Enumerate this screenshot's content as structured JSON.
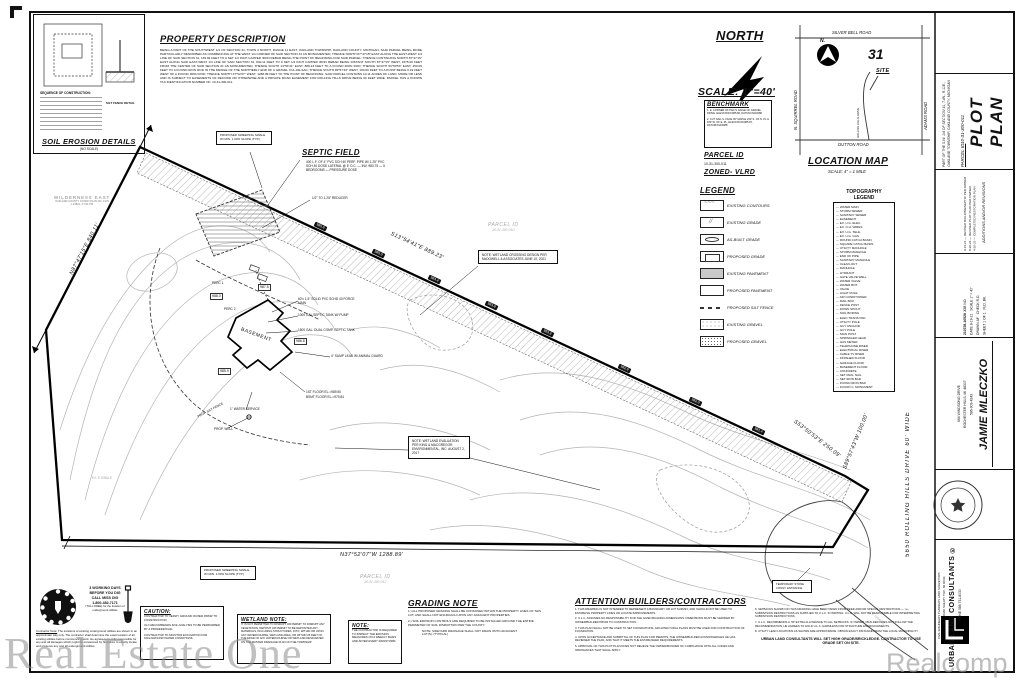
{
  "watermarks": {
    "left": "Real Estate One",
    "right": "Realcomp"
  },
  "property_description": {
    "title": "PROPERTY DESCRIPTION",
    "body": "BEING A PART OF THE SOUTHWEST 1/4 OF SECTION 31, TOWN 4 NORTH, RANGE 11 EAST, OAKLAND TOWNSHIP, OAKLAND COUNTY, MICHIGAN, SAID PARCEL BEING MORE PARTICULARLY DESCRIBED AS COMMENCING AT THE WEST 1/4 CORNER OF SAID SECTION 31 AS MONUMENTED; THENCE NORTH 87°47'15\" EAST ALONG THE EAST-WEST 1/4 LINE OF SAID SECTION 31, 139.84 FEET TO A SET 1/2 INCH CAPPED IRON REBAR BEING THE POINT OF BEGINNING FOR SAID PARCEL; THENCE CONTINUING NORTH 87°47'15\" EAST ALONG SAID EAST-WEST 1/4 LINE OF SAID SECTION 31, 840.11 FEET TO A SET 1/2 INCH CAPPED IRON REBAR BEING DISTANT SOUTH 87°47'15\" WEST, 1575.06 FEET FROM THE CENTER OF SAID SECTION 31 AS MONUMENTED; THENCE SOUTH 13°54'41\" EAST, 889.23 FEET TO A FOUND IRON ROD; THENCE SOUTH 53°50'53\" EAST, 250.09 FEET TO A FOUND IRON ROD IN THE MIDDLE OF THE NORTHERLY END OF A GRAVEL CUL-DE-SAC; THENCE SOUTH 89°57'43\" WEST, 100.00 FEET TO A POINT BEING 0.19 FEET WEST OF A FOUND IRON ROD; THENCE NORTH 37°52'07\" WEST, 1288.89 FEET TO THE POINT OF BEGINNING. SAID PARCEL CONTAINS 10.11 ACRES OF LAND, MORE OR LESS AND IS SUBJECT TO EASEMENTS OF RECORD OR OTHERWISE AND A PRIVATE ROAD EASEMENT FOR ROLLING HILLS DRIVE BEING 60 FEET WIDE. PARCEL HAS A KNOWN TAX IDENTIFICATION NUMBER OF: 10-31-300-011."
  },
  "soil_erosion": {
    "title": "SOIL EROSION DETAILS",
    "subtitle": "(NO SCALE)",
    "sequence_title": "SEQUENCE OF CONSTRUCTION:",
    "silt_detail_label": "SILT FENCE DETAIL"
  },
  "north_block": {
    "north_label": "NORTH",
    "scale_label": "SCALE:  1\"=40'"
  },
  "benchmark": {
    "title": "BENCHMARK",
    "items": [
      "1.  E. CORNER OF PAD S. EDGE OF GRAVEL DRIVE, ELEVATION=985.80, DATUM=NAVD88",
      "2.  CUT NAIL S. FACE 36\" MAPLE 230' S. OF N. PL & 180' W. OF E. PL, ELEVATION=985.87, DATUM=NAVD88"
    ]
  },
  "parcel_block": {
    "parcel_title": "PARCEL ID",
    "parcel_value": "10-31-300-011",
    "zoned": "ZONED- VLRD"
  },
  "location_map": {
    "title": "LOCATION MAP",
    "scale": "SCALE:  4\" = 1 MILE",
    "section_number": "31",
    "site_label": "SITE",
    "north_label": "N.",
    "roads": {
      "top": "SILVER BELL ROAD",
      "left": "N. SQUIRREL ROAD",
      "right": "ADAMS ROAD",
      "bottom": "DUTTON ROAD",
      "site_road": "ROLLING HILLS DRIVE"
    }
  },
  "legend": {
    "title": "LEGEND",
    "items": [
      {
        "type": "contour",
        "label": "EXISTING CONTOURS"
      },
      {
        "type": "exgrade",
        "label": "EXISTING GRADE"
      },
      {
        "type": "asbuilt",
        "label": "AS-BUILT GRADE"
      },
      {
        "type": "propgrade",
        "label": "PROPOSED GRADE"
      },
      {
        "type": "expave",
        "label": "EXISTING PAVEMENT"
      },
      {
        "type": "propave",
        "label": "PROPOSED PAVEMENT"
      },
      {
        "type": "silt",
        "label": "PROPOSED SILT FENCE"
      },
      {
        "type": "exgravel",
        "label": "EXISTING GRAVEL"
      },
      {
        "type": "propgravel",
        "label": "PROPOSED GRAVEL"
      }
    ]
  },
  "topo_legend": {
    "title_line1": "TOPOGRAPHY",
    "title_line2": "LEGEND",
    "items": [
      "WATER MAIN",
      "STORM SEWER",
      "SANITARY SEWER",
      "EASEMENT",
      "EX. U.G. ELEC.",
      "EX. O.H. WIRES",
      "EX. U.G. TELE.",
      "EX. U.G. GAS",
      "ROUND CATCH BASIN",
      "SQUARE CATCH BASIN",
      "UTILITY MANHOLE",
      "STORM MANHOLE",
      "END OF PIPE",
      "SANITARY MANHOLE",
      "CLEAN-OUT",
      "MANHOLE",
      "HYDRANT",
      "GATE VALVE WELL",
      "WATER VALVE",
      "WATER BOX",
      "VALVE",
      "LIGHT POLE",
      "AIR CONDITIONER",
      "MAIL BOX",
      "FENCE POST",
      "DOWN SPOUT",
      "SOIL BORING",
      "ELEC TRANS PAD",
      "UTILITY POLE",
      "GUY ANCHOR",
      "GUY POLE",
      "SIGN POST",
      "SPRINKLER HEAD",
      "GAS METER",
      "TELEPHONE RISER",
      "ELECTRICAL RISER",
      "CABLE TV RISER",
      "FINISHED FLOOR",
      "GARAGE FLOOR",
      "BASEMENT FLOOR",
      "CONCRETE",
      "SET MAG. NAIL",
      "SET IRON BAR",
      "FOUND IRON BAR",
      "FOUND C. MONUMENT"
    ]
  },
  "plan": {
    "bearing_nw": "N87°47'15\"E  840.11'",
    "bearing_ne": "S13°54'41\"E  889.23'",
    "bearing_se": "S53°50'53\"E  250.09'",
    "bearing_east": "S89°57'43\"W  100.00'",
    "bearing_south": "N37°52'07\"W  1288.89'",
    "road_label": "5650 ROLLING HILLS DRIVE 60' WIDE",
    "adjacent_parcel_1a": "PARCEL ID",
    "adjacent_parcel_1b": "10-31-300-010",
    "adjacent_parcel_2a": "PARCEL ID",
    "adjacent_parcel_2b": "10-31-300-012",
    "condo_name": "WILDERNESS EAST",
    "condo_line2": "OAKLAND COUNTY CONDO PLAN NO. 1379",
    "condo_line3": "L.23841, P.746-763",
    "septic_title": "SEPTIC FIELD",
    "septic_note": "400 L.F. OF 4\" PVC SCH 40 PERF. PIPE W/ 1.25\" PVC SCH 40 DOSE LATERAL @ 5' O.C. — INV. 983.75 — 5 BEDROOMS — PRESSURE DOSE",
    "septic_reducer": "1/2\" TO 1.25\" REDUCER",
    "swale_note_1": "PROPOSED SWEEPING SWALE W/ MIN. 1.00% SLOPE (TYP.)",
    "swale_note_2": "PROPOSED SWEEPING SWALE W/ MIN. 1.00% SLOPE (TYP.)",
    "wetland_crossing_note": "NOTE: WETLAND CROSSING DESIGN PER McDOWELL & ASSOCIATES JUNE 10, 2021",
    "wetland_eval_note": "NOTE: WETLAND EVALUATION PER KING & MACGREGOR ENVIRONMENTAL, INC. AUGUST 2, 2017",
    "basement_label": "BASEMENT",
    "house": {
      "notes": [
        "60'± 1.5\" SOLID PVC SCHD 40 FORCE MAIN",
        "1000 GAL SEPTIC TANK W/ PUMP",
        "1500 GAL. DUAL COMP. SEPTIC TANK",
        "4\" SUMP LEAD W/ ANIMAL GUARD",
        "1ST FLOOR EL.=989.50",
        "BSMT FLOOR EL.=979.84",
        "1\" WATER SERVICE",
        "PROP. WELL"
      ],
      "perc1": "PERC 1",
      "perc2": "PERC 2"
    },
    "silt_fence_label": "PROP. SILT FENCE",
    "temp_entrance": "TEMPORARY STONE CONST. ENTRANCE",
    "ex_swale": "EX. E SWALE",
    "ex_gravel": "EX. GRAVEL",
    "grade_labels": [
      "985.6",
      "985.0",
      "984.4",
      "983.8",
      "983.2",
      "982.6",
      "982.0",
      "981.4"
    ],
    "spot_grades": [
      "988.0",
      "987.5",
      "986.8",
      "985.9"
    ]
  },
  "grading_note": {
    "title": "GRADING NOTE",
    "items": [
      "1.)  ALL PROPOSED GRADING SHALL BE CONTAINED WITHIN THE PROPERTY LINES OF THIS LOT, AND SHALL NOT ENCROACH UPON ANY ADJACENT PROPERTIES.",
      "2.)  SOIL EROSION CONTROLS ARE REQUIRED TO BE INSTALLED AROUND THE ENTIRE PERIMETER OF SOIL DISRUPTION PER THE COUNTY."
    ],
    "sub_note": "NOTE: SIDEYARD DRAINAGE SHALL NOT DRAIN ONTO ADJACENT LOT(S). (TYPICAL)"
  },
  "attention": {
    "title": "ATTENTION BUILDERS/CONTRACTORS",
    "left_items": [
      "1. THIS DRAWING IS NOT INTENDED TO REPRESENT A BOUNDARY OR LOT SURVEY, AND SHOULD NOT BE USED TO ESTABLISH PROPERTY LINES OR LOCATE IMPROVEMENTS.",
      "2. U.L.C. ASSUMES NO RESPONSIBILITY FOR THE GIVEN BUILDING DIMENSIONS. DIMENSIONS MUST BE VERIFIED BY OWNER/BUILDER PRIOR TO CONSTRUCTION.",
      "3. THIS PLAN SHALL NOT BE USED TO SET FOUNDATIONS. ARCHITECTURAL PLANS MUST BE USED FOR CONSTRUCTION OF FOUNDATION.",
      "4. UPON ACCEPTANCE AND SUBMITTAL OF THIS PLAN FOR PERMITS, THE OWNER/BUILDER ACKNOWLEDGES HE HAS REVIEWED THE PLAN, AND THAT IT MEETS THE ESTABLISHED REQUIREMENTS.",
      "5. APPROVAL OF THIS PLOT PLAN DOES NOT RELIEVE THE OWNER/BUILDER OF COMPLIANCE WITH ALL CODES AND ORDINANCES THAT SHALL APPLY."
    ],
    "right_items": [
      "6. SETBACKS SHOWN ON THIS DRAWING HAVE BEEN TAKEN FROM DEED AND/OR SPECIAL RESTRICTIONS — i.e., SUBDIVISION RESTRICTIONS AS SUPPLIED TO U.L.C. IN WRITING. U.L.C. WILL NOT BE RESPONSIBLE FOR INTERPRETING SUBDIVISION RESTRICTIONS.",
      "7. U.L.C. RECOMMENDS A .50' EXTRA ALLOWANCE TO ALL SETBACKS. IF OWNER / BUILDER DOES NOT FOLLOW THE RECOMMENDATION, HE AGREES TO HOLD U.L.C. HARMLESS FOR STRUCTURE ENCROACHMENTS.",
      "8. UTILITY LEAD LOCATIONS AS SHOWN ARE APPROXIMATE. OBTAIN EXACT DISTANCE FROM THE LOCAL MUNICIPALITY."
    ],
    "footer": "URBAN LAND CONSULTANTS WILL SET HIGH GRADE/BRICKLEDGE. CONTRACTOR TO USE GRADE SET ON SITE."
  },
  "caution": {
    "title": "CAUTION:",
    "items": [
      "CONTRACTOR TO VERIFY GROUND WATER PRIOR TO CONSTRUCTION.",
      "ULC RECOMMENDS SOIL ANALYSIS TO BE PERFORMED BY A PROFESSIONAL.",
      "CONTRACTOR TO MONITOR EXCAVATION FOR SOIL/GROUND WATER CONDITIONS."
    ]
  },
  "wetland_note": {
    "title": "WETLAND NOTE:",
    "body": "IT IS NOT PERMITTED TO DISRUPT OR PERMIT TO DISRUPT ANY VEGETATION, DEPOSIT OR PERMIT TO BE DEPOSITED ANY MATERIALS, INCLUDING STRUCTURES, INTO, WITHIN OR UPON ANY WATERCOURSE, WETLAND AREA, OR WITHIN 25 FEET OF THE EDGE OF ANY WATERCOURSE OR WETLAND DESIGNATED ON THE MASTER DRAINAGE PLAN ON THE TOWNSHIP."
  },
  "note_box": {
    "title": "NOTE:",
    "body": "THE CONTRACTOR IS REQUIRED TO INSPECT THE EROSION MEASURES ON A WEEKLY BASIS AND AFTER EVERY RAINSTORM."
  },
  "missdig": {
    "line1": "3 WORKING DAYS",
    "line2": "BEFORE YOU DIG",
    "line3": "CALL MISS DIG",
    "phone": "1-800-482-7171",
    "line5": "(TOLL FREE) for the location of underground utilities",
    "contractor_note_title": "Contractor Note:",
    "contractor_note": "The locations of existing underground utilities are shown in an approximate way only. The contractor shall determine the exact location of all existing utilities before commencing work. He agrees to be fully responsible for any and all damages which might be occasioned by his failure to exactly locate and preserve any and all underground utilities."
  },
  "titleblock": {
    "plot_plan": "PLOT PLAN",
    "parcel_label": "PARCEL ID",
    "parcel_value": "10-31-300-011",
    "description": "PART OF THE S.W. 1/4 OF SECTION 31, T.4N., R.11E., OAKLAND TOWNSHIP, OAKLAND COUNTY, MICHIGAN",
    "revisions_label": "ADDITIONS AND/OR REVISIONS",
    "revisions": [
      {
        "date": "9-16-21",
        "text": "REVISED BUILDING/SEPTIC PER OWNER"
      },
      {
        "date": "8-30-22",
        "text": "REVISED PLOT PLAN PER OWNER"
      },
      {
        "date": "4-20-23",
        "text": "COMPLETED RESTORATION PLAN"
      }
    ],
    "job_no": "210728-10528",
    "job_no_label": "JOB NO.",
    "date_label": "DATE",
    "date": "8-19-21",
    "scale_label": "SCALE",
    "scale": "1\" = 40'",
    "drawn_label": "DRAWN",
    "drawn": "AF",
    "check_label": "CHECK",
    "check": "R.D.",
    "sheet_label": "SHEET",
    "sheet": "1 OF 1",
    "fldbk_label": "FLD. BK.",
    "client_name": "JAMIE MLECZKO",
    "client_addr1": "664 WINDSONG DRIVE",
    "client_addr2": "ROCHESTER HILLS, MI 48307",
    "client_phone": "586-909-4243",
    "firm_name": "URBAN LAND CONSULTANTS ®",
    "firm_phone": "PHONE 586 731-8030",
    "firm_services": "CIVIL ENGINEERS   PLANNERS   LAND SURVEYORS",
    "firm_addr": "8900 23 MILE ROAD   SHELBY TWP., MI 48316"
  }
}
